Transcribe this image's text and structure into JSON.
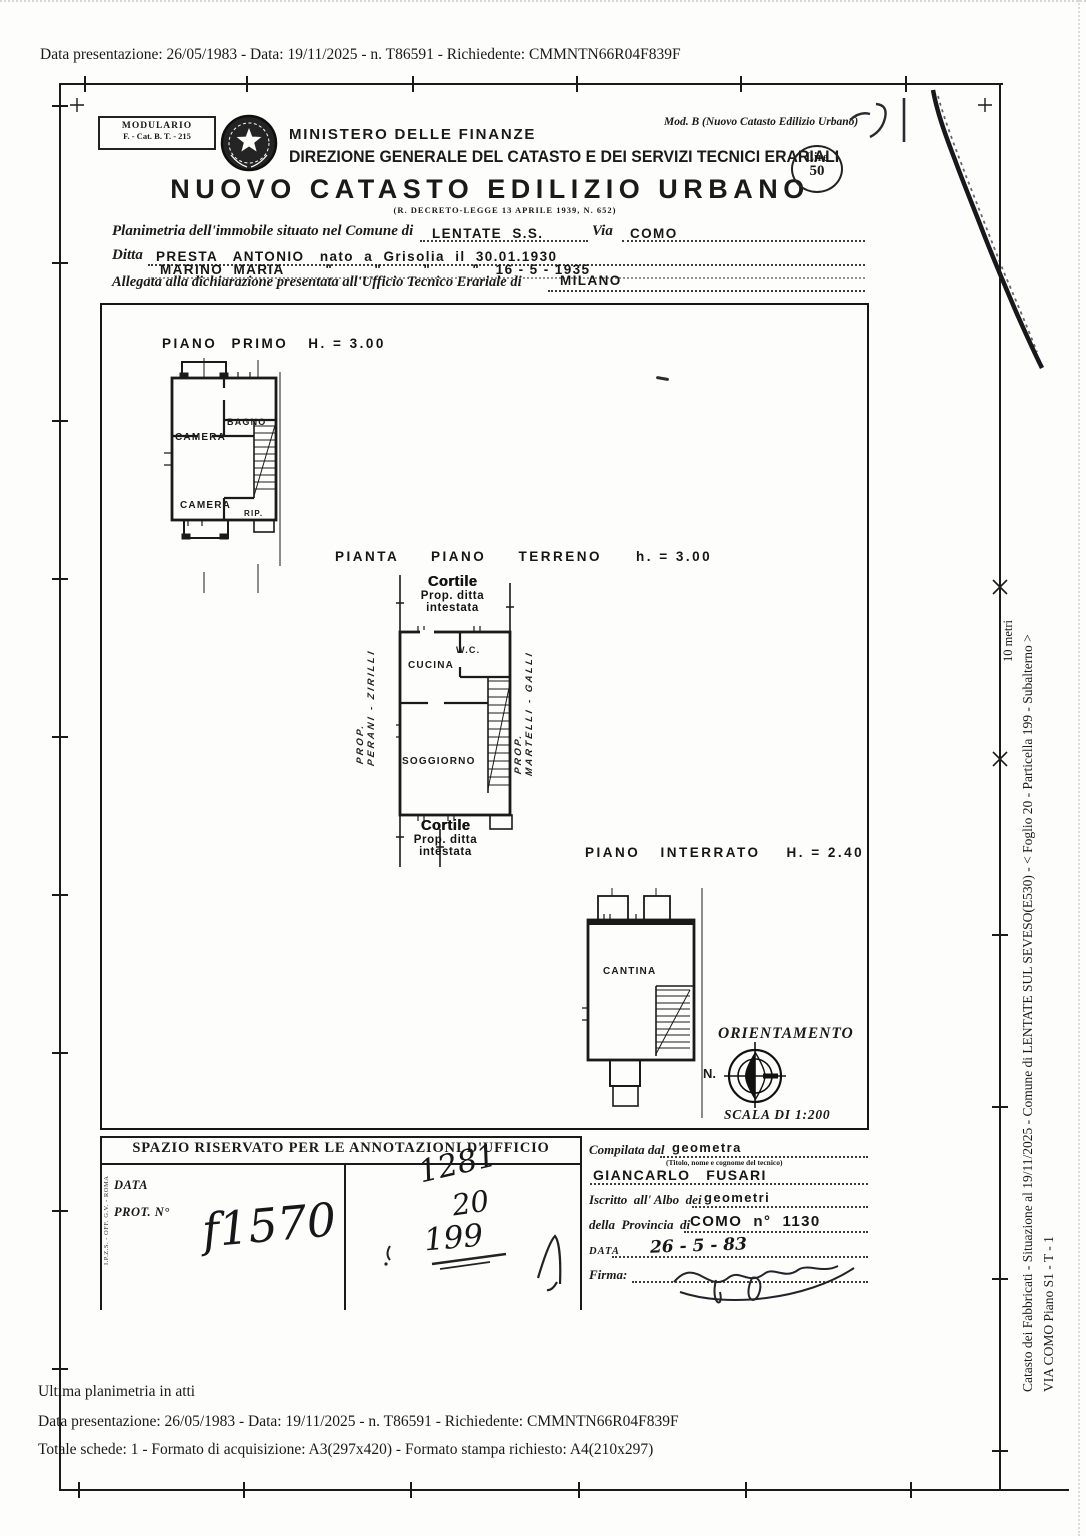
{
  "page": {
    "scan_line_top": "Data presentazione: 26/05/1983 - Data: 19/11/2025 - n. T86591 - Richiedente: CMMNTN66R04F839F"
  },
  "header": {
    "modulario_line1": "MODULARIO",
    "modulario_line2": "F. - Cat. B. T. - 215",
    "mod_b_note": "Mod. B (Nuovo Catasto Edilizio Urbano)",
    "ministry": "MINISTERO DELLE FINANZE",
    "direzione": "DIREZIONE GENERALE DEL CATASTO E DEI SERVIZI TECNICI ERARIALI",
    "title": "NUOVO CATASTO EDILIZIO URBANO",
    "law_ref": "(R. DECRETO-LEGGE 13 APRILE 1939, N. 652)",
    "stamp": {
      "currency": "Lire",
      "amount": "50"
    }
  },
  "form": {
    "planimetria_label": "Planimetria dell'immobile situato nel Comune di",
    "comune_value": "LENTATE  S.S.",
    "via_label": "Via",
    "via_value": "COMO",
    "ditta_label": "Ditta",
    "ditta_value1": "PRESTA   ANTONIO   nato  a  Grisolia  il  30.01.1930",
    "ditta_value2": "MARINO  MARIA        \"        \"        \"        \"   16 - 5 - 1935",
    "allegata_label": "Allegata alla dichiarazione presentata all'Ufficio Tecnico Erariale di",
    "ufficio_value": "MILANO"
  },
  "plans": {
    "prop_label": "PROP.",
    "first_floor": {
      "title": "PIANO  PRIMO",
      "height": "H. = 3.00",
      "rooms": [
        "CAMERA",
        "BAGNO",
        "CAMERA",
        "RIP."
      ]
    },
    "ground_floor": {
      "title": "PIANTA PIANO TERRENO",
      "height": "h. =  3.00",
      "rooms": [
        "CUCINA",
        "W.C.",
        "SOGGIORNO"
      ],
      "cortile": "Cortile",
      "cortile_sub1": "Prop.  ditta",
      "cortile_sub2": "intestata",
      "left_prop": "PERANI - ZIRILLI",
      "right_prop": "MARTELLI - GALLI"
    },
    "basement": {
      "title": "PIANO  INTERRATO",
      "height": "H. = 2.40",
      "rooms": [
        "CANTINA"
      ]
    },
    "orientation": {
      "title": "ORIENTAMENTO",
      "north_label": "N.",
      "scale_label": "SCALA DI 1:200"
    }
  },
  "annotations": {
    "title": "SPAZIO RISERVATO PER LE ANNOTAZIONI D'UFFICIO",
    "data_label": "DATA",
    "prot_label": "PROT. N°",
    "imprint": "I.P.Z.S. - OFF. G.V. - ROMA",
    "handwriting_left": "f1570",
    "handwriting_num1": "1281",
    "handwriting_num2": "20",
    "handwriting_num3": "199"
  },
  "technician": {
    "compilata_label": "Compilata dal",
    "compilata_value": "geometra",
    "titolo_note": "(Titolo, nome e cognome del tecnico)",
    "name_value": "GIANCARLO   FUSARI",
    "iscritto_label": "Iscritto  all' Albo  dei",
    "iscritto_value": "geometri",
    "provincia_label": "della  Provincia  di",
    "provincia_value": "COMO  n°  1130",
    "data_label": "DATA",
    "data_value": "26 - 5 - 83",
    "firma_label": "Firma:"
  },
  "sidebar": {
    "scale_label": "10 metri",
    "caption_line1": "Catasto dei Fabbricati - Situazione al 19/11/2025 - Comune di LENTATE SUL SEVESO(E530) - < Foglio 20 - Particella 199 - Subalterno  >",
    "caption_line2": "VIA COMO Piano S1 - T - 1"
  },
  "footer": {
    "line1": "Ultima planimetria in atti",
    "line2": "Data presentazione: 26/05/1983 - Data: 19/11/2025 - n. T86591 - Richiedente: CMMNTN66R04F839F",
    "line3": "Totale schede: 1 - Formato di acquisizione: A3(297x420)  - Formato stampa richiesto: A4(210x297)"
  },
  "colors": {
    "ink": "#1a1a1a",
    "paper": "#fdfdfb"
  }
}
